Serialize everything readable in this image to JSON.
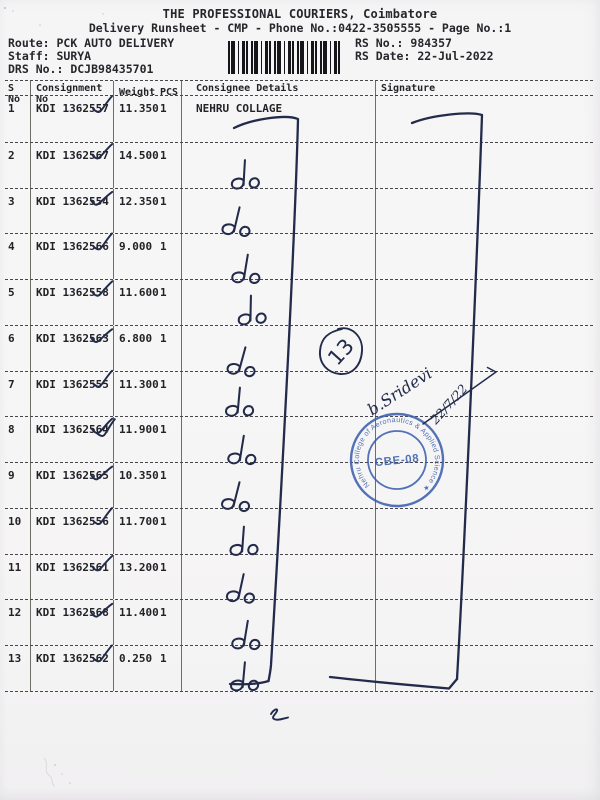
{
  "header": {
    "title": "THE PROFESSIONAL COURIERS, Coimbatore",
    "subtitle": "Delivery Runsheet - CMP - Phone No.:0422-3505555 - Page No.:1",
    "route_label": "Route:",
    "route_value": "PCK AUTO DELIVERY",
    "staff_label": "Staff:",
    "staff_value": "SURYA",
    "drs_label": "DRS No.:",
    "drs_value": "DCJB98435701",
    "rs_no_label": "RS No.:",
    "rs_no_value": "984357",
    "rs_date_label": "RS Date:",
    "rs_date_value": "22-Jul-2022"
  },
  "table": {
    "col_headers": {
      "sno": "S No",
      "consignment": "Consignment No",
      "weight": "Weight",
      "pcs": "PCS",
      "consignee": "Consignee Details",
      "signature": "Signature"
    },
    "rows": [
      {
        "sno": "1",
        "consignment": "KDI 1362557",
        "weight": "11.350",
        "pcs": "1",
        "consignee": "NEHRU COLLAGE",
        "check": "single",
        "ditto": false
      },
      {
        "sno": "2",
        "consignment": "KDI 1362567",
        "weight": "14.500",
        "pcs": "1",
        "consignee": "",
        "check": "single",
        "ditto": true
      },
      {
        "sno": "3",
        "consignment": "KDI 1362554",
        "weight": "12.350",
        "pcs": "1",
        "consignee": "",
        "check": "single",
        "ditto": true
      },
      {
        "sno": "4",
        "consignment": "KDI 1362566",
        "weight": "9.000",
        "pcs": "1",
        "consignee": "",
        "check": "single",
        "ditto": true
      },
      {
        "sno": "5",
        "consignment": "KDI 1362558",
        "weight": "11.600",
        "pcs": "1",
        "consignee": "",
        "check": "single",
        "ditto": true
      },
      {
        "sno": "6",
        "consignment": "KDI 1362563",
        "weight": "6.800",
        "pcs": "1",
        "consignee": "",
        "check": "single",
        "ditto": true
      },
      {
        "sno": "7",
        "consignment": "KDI 1362555",
        "weight": "11.300",
        "pcs": "1",
        "consignee": "",
        "check": "single",
        "ditto": true
      },
      {
        "sno": "8",
        "consignment": "KDI 1362564",
        "weight": "11.900",
        "pcs": "1",
        "consignee": "",
        "check": "double",
        "ditto": true
      },
      {
        "sno": "9",
        "consignment": "KDI 1362565",
        "weight": "10.350",
        "pcs": "1",
        "consignee": "",
        "check": "single",
        "ditto": true
      },
      {
        "sno": "10",
        "consignment": "KDI 1362556",
        "weight": "11.700",
        "pcs": "1",
        "consignee": "",
        "check": "single",
        "ditto": true
      },
      {
        "sno": "11",
        "consignment": "KDI 1362561",
        "weight": "13.200",
        "pcs": "1",
        "consignee": "",
        "check": "single",
        "ditto": true
      },
      {
        "sno": "12",
        "consignment": "KDI 1362568",
        "weight": "11.400",
        "pcs": "1",
        "consignee": "",
        "check": "single",
        "ditto": true
      },
      {
        "sno": "13",
        "consignment": "KDI 1362562",
        "weight": "0.250",
        "pcs": "1",
        "consignee": "",
        "check": "single",
        "ditto": true
      }
    ]
  },
  "annotations": {
    "circled_number": "13",
    "ditto_mark": "do",
    "signature_name": "b.Sridevi",
    "signature_date": "22/7/22"
  },
  "stamp": {
    "center_text": "CBE-08",
    "ring_text": "Nehru College of Aeronautics & Applied Science ★",
    "color": "#3c5fae"
  },
  "colors": {
    "ink": "#222b4a",
    "print": "#26262b",
    "stamp": "#3c5fae",
    "paper": "#f6f5f6"
  }
}
